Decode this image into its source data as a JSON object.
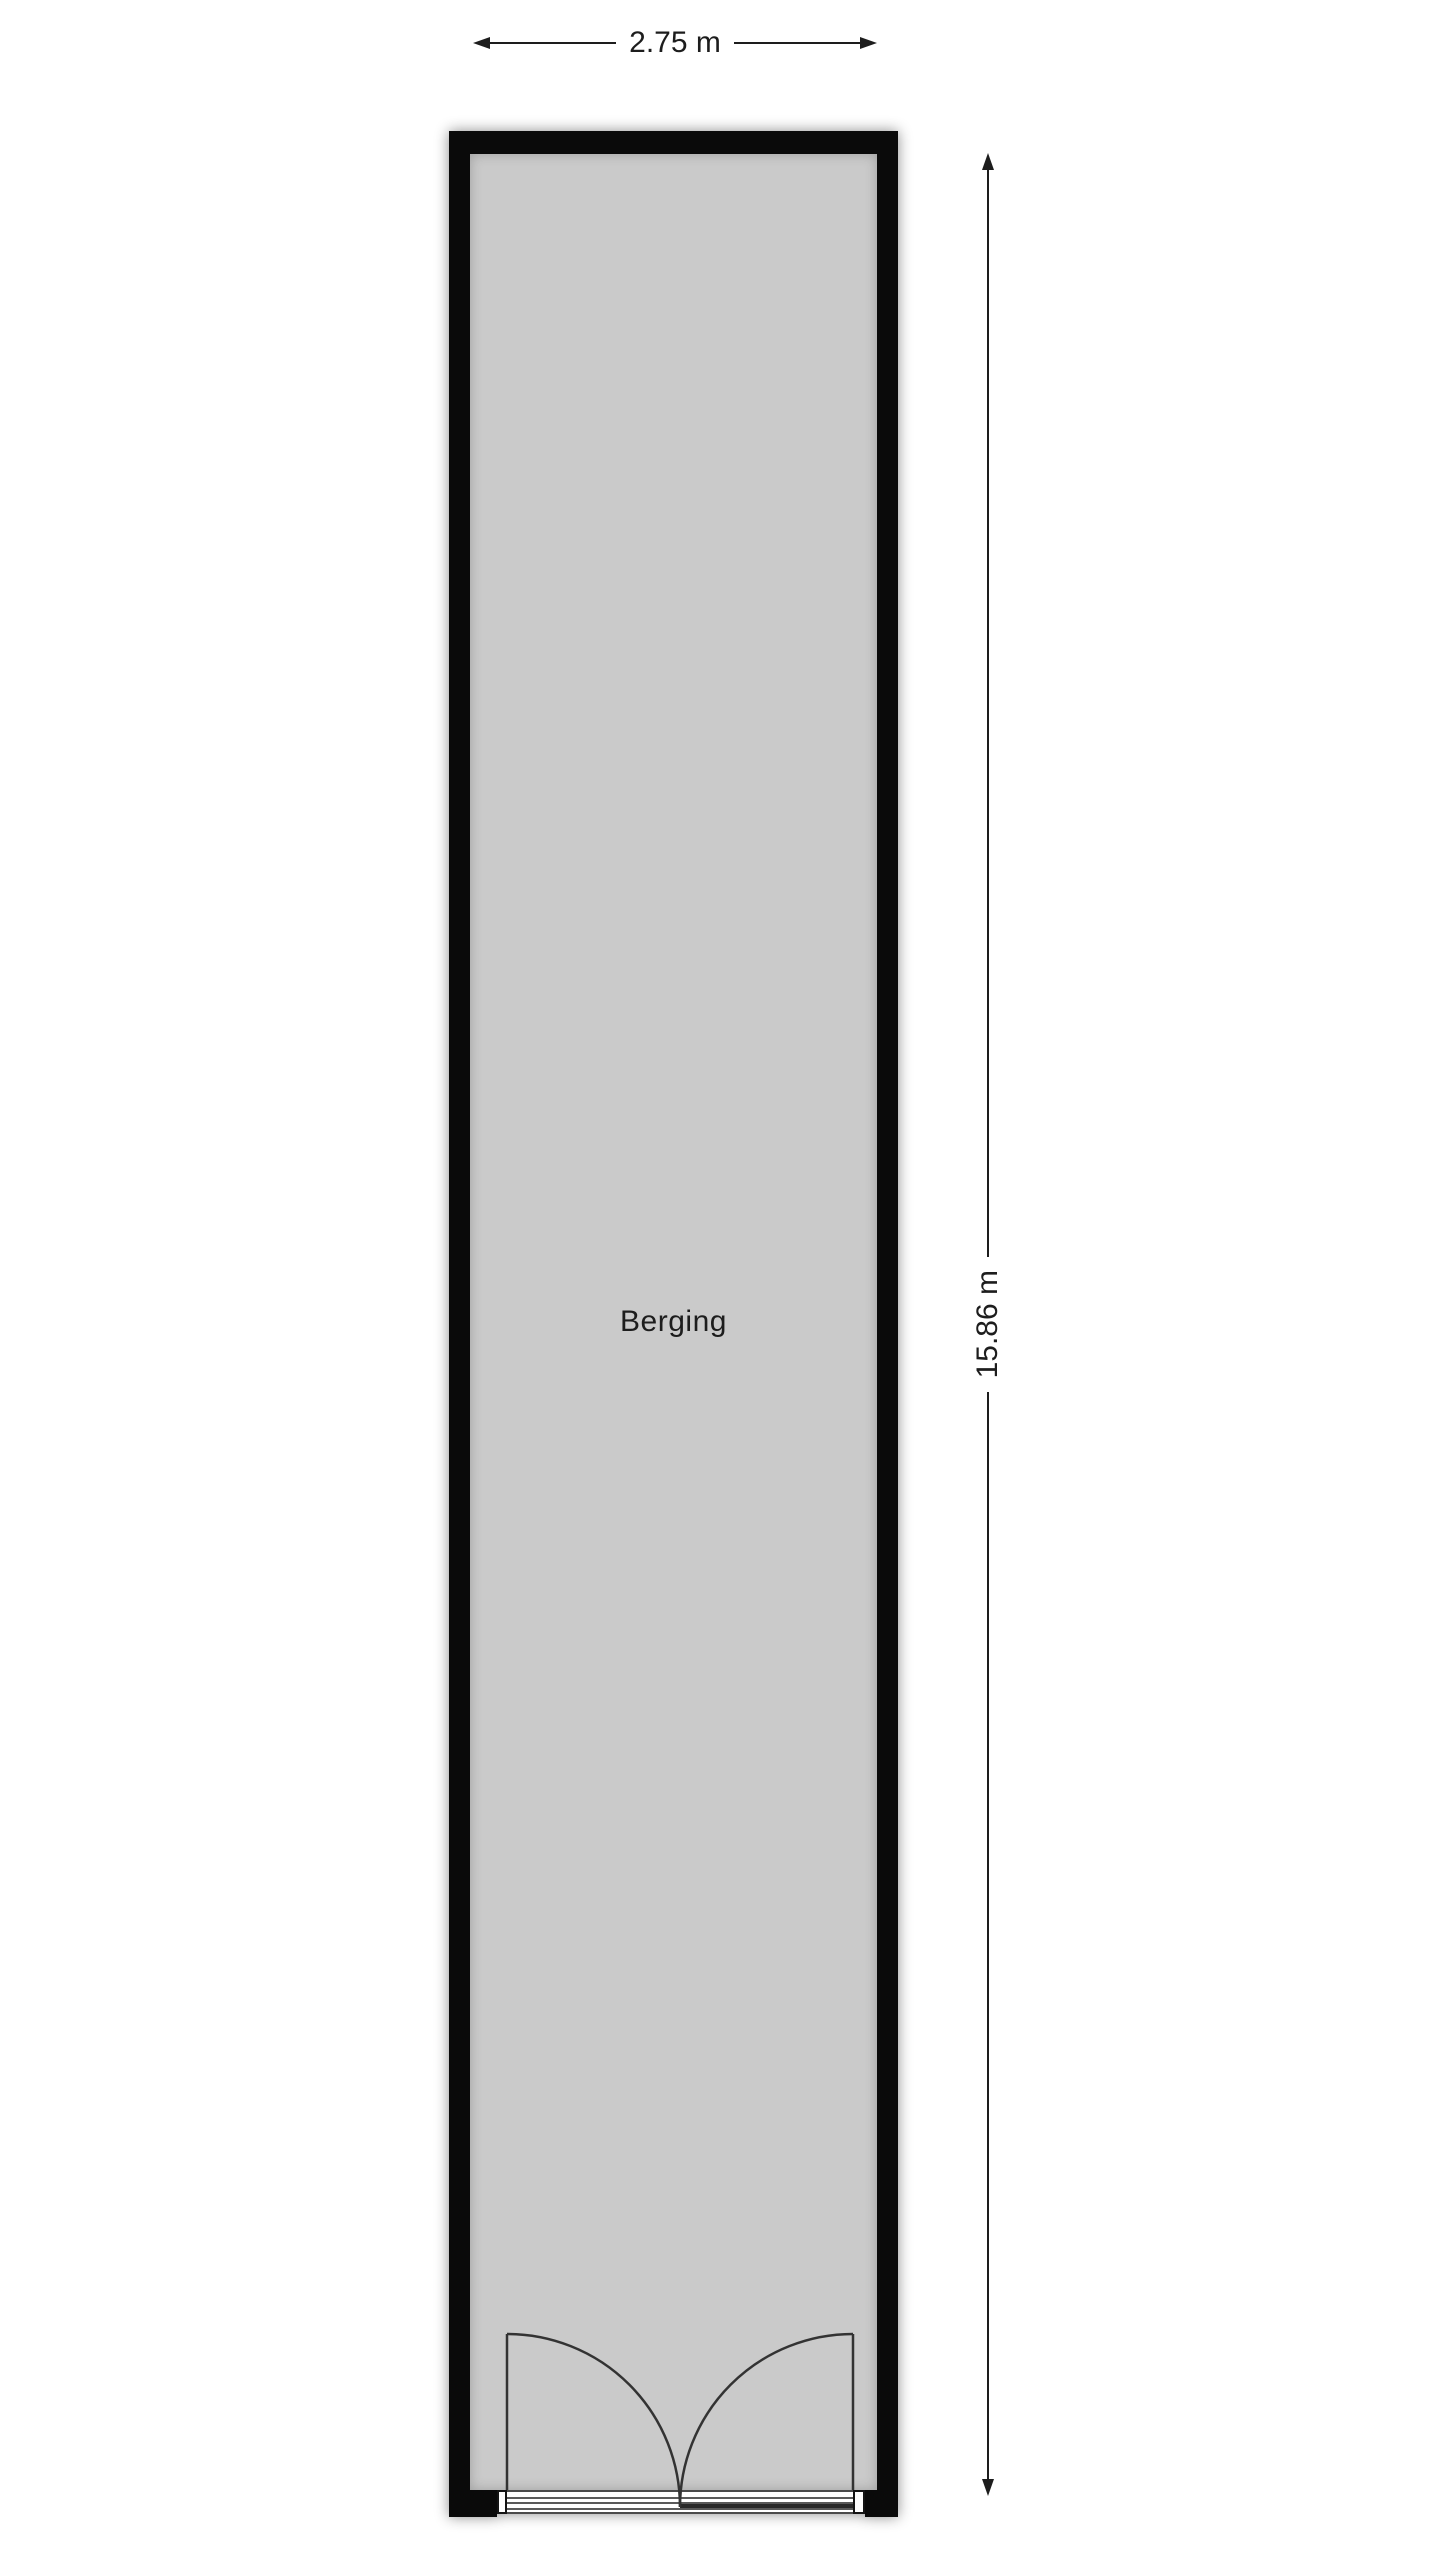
{
  "floorplan": {
    "room_label": "Berging",
    "width_dimension": "2.75 m",
    "height_dimension": "15.86 m",
    "colors": {
      "wall": "#0a0a0a",
      "floor": "#cacaca",
      "outline": "#3a3a3a",
      "text": "#1d1d1d",
      "background": "#ffffff"
    }
  }
}
